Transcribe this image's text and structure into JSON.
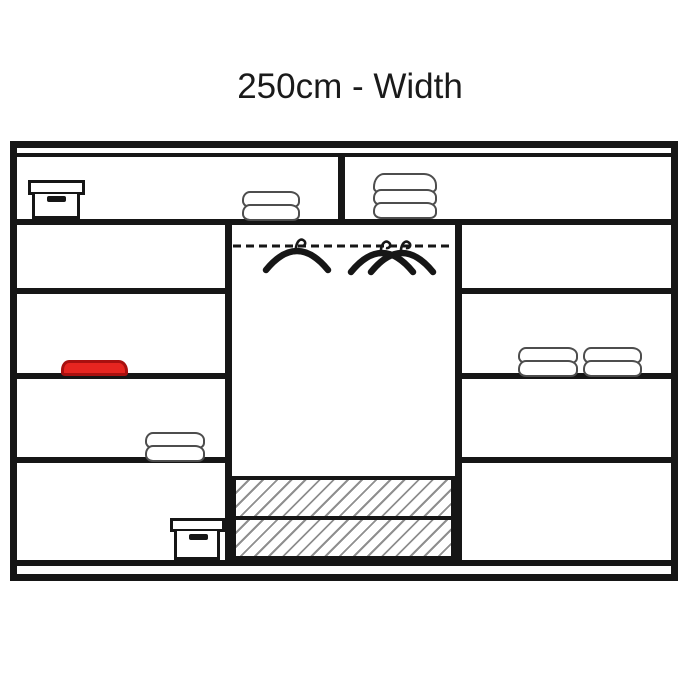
{
  "title": "250cm - Width",
  "colors": {
    "line": "#161616",
    "background": "#ffffff",
    "red_item": "#e62520",
    "red_item_border": "#a8100f",
    "towel_outline": "#4d4d4d",
    "hatch": "#8f8f8f"
  },
  "diagram": {
    "kind": "wardrobe interior layout drawing",
    "hanger_count": 3,
    "drawer_count": 2,
    "sections": [
      {
        "name": "top-shelf-row",
        "contents": [
          "storage box with lid (left)",
          "2-layer folded towels (left section)",
          "3-layer folded towels (right section)"
        ]
      },
      {
        "name": "left-shelf-column",
        "shelves": 4,
        "contents": [
          "empty shelf",
          "red folded garment",
          "2-layer folded towels",
          "storage box with lid"
        ]
      },
      {
        "name": "center-hanging-section",
        "contents": [
          "dashed hanging rail",
          "3 clothes hangers",
          "2 hatched drawers at bottom"
        ]
      },
      {
        "name": "right-shelf-column",
        "shelves": 4,
        "contents": [
          "empty shelf",
          "two 2-layer folded towel stacks",
          "empty shelf",
          "empty shelf"
        ]
      }
    ]
  }
}
